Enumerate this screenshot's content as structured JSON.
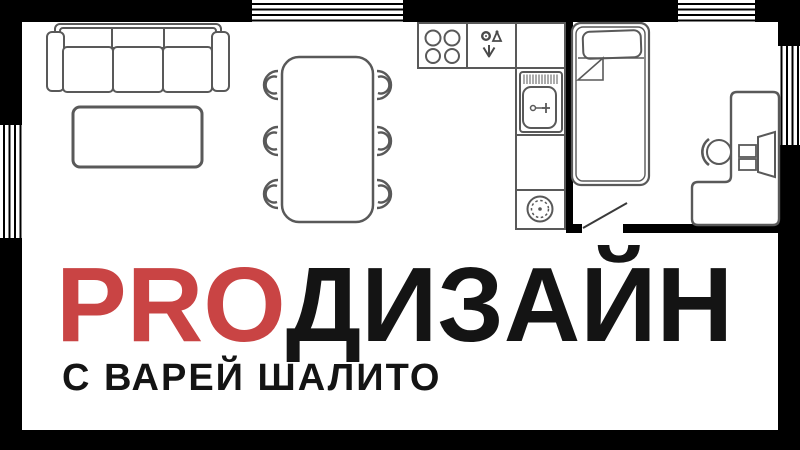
{
  "brand": {
    "title": "PROДИЗАЙН",
    "title_accent": "PRO",
    "title_rest": "ДИЗАЙН",
    "subtitle": "С ВАРЕЙ ШАЛИТО",
    "accent_color": "#C94444",
    "ink_color": "#141414"
  },
  "floorplan": {
    "wall_color": "#000000",
    "furniture_line_color": "#595959",
    "window_count": 4,
    "rooms": [
      {
        "name": "living-dining-room",
        "furniture": [
          "sofa",
          "coffee-table",
          "dining-table",
          "six-chairs"
        ]
      },
      {
        "name": "kitchen",
        "furniture": [
          "stove-4-burners",
          "dishwasher",
          "counter",
          "sink-with-faucet",
          "washing-machine"
        ]
      },
      {
        "name": "bedroom-office",
        "furniture": [
          "single-bed-with-pillow",
          "door",
          "l-shaped-desk",
          "desk-chair",
          "monitor"
        ]
      }
    ]
  }
}
